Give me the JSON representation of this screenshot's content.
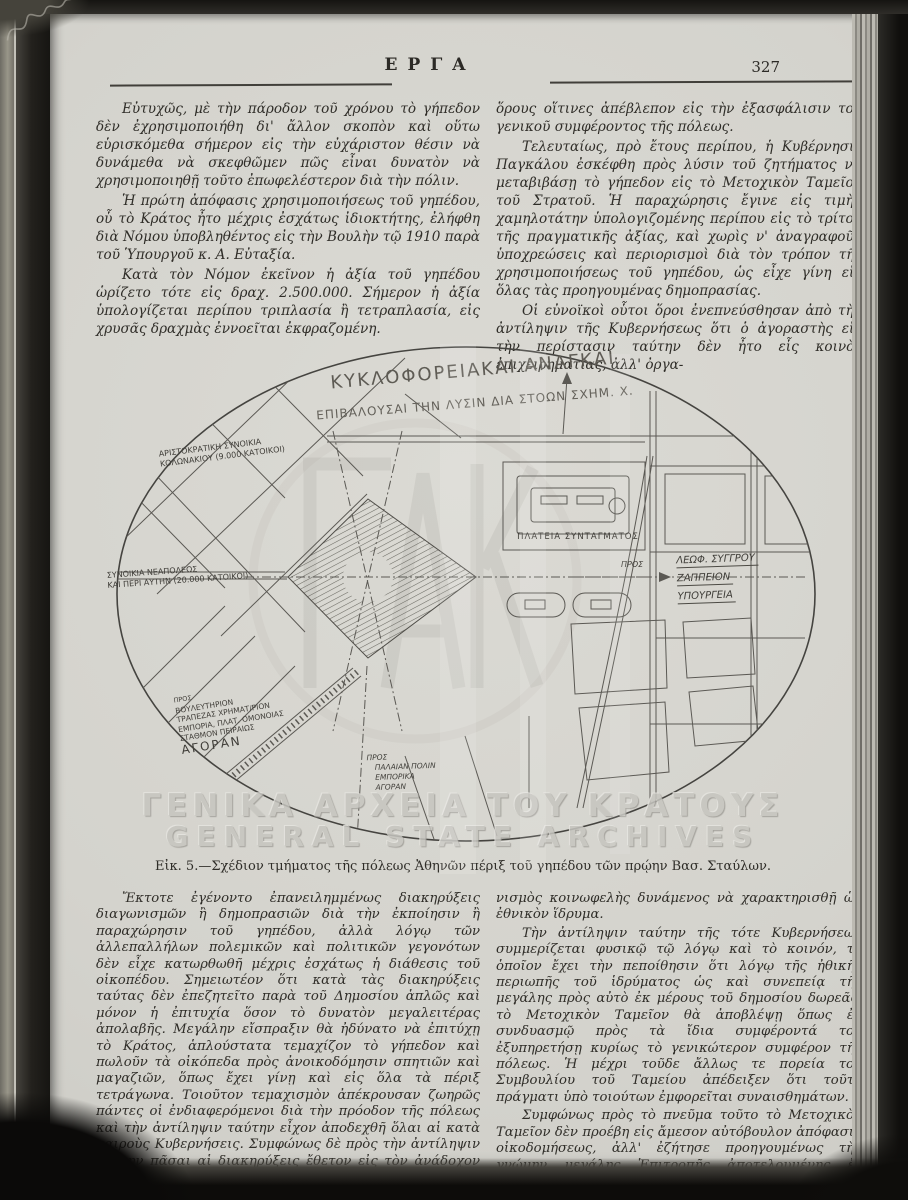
{
  "header": {
    "journal_title": "ΕΡΓΑ",
    "page_number": "327"
  },
  "top_section": {
    "left_column": {
      "paragraphs": [
        "Εὐτυχῶς, μὲ τὴν πάροδον τοῦ χρόνου τὸ γήπεδον δὲν ἐχρησιμοποιήθη δι' ἄλλον σκοπὸν καὶ οὕτω εὑρισκόμεθα σήμερον εἰς τὴν εὐχάριστον θέσιν νὰ δυνάμεθα νὰ σκεφθῶμεν πῶς εἶναι δυνατὸν νὰ χρησιμοποιηθῇ τοῦτο ἐπωφελέστερον διὰ τὴν πόλιν.",
        "Ἡ πρώτη ἀπόφασις χρησιμοποιήσεως τοῦ γηπέδου, οὗ τὸ Κράτος ἦτο μέχρις ἐσχάτως ἰδιοκτήτης, ἐλήφθη διὰ Νόμου ὑποβληθέντος εἰς τὴν Βουλὴν τῷ 1910 παρὰ τοῦ Ὑπουργοῦ κ. Α. Εὐταξία.",
        "Κατὰ τὸν Νόμον ἐκεῖνον ἡ ἀξία τοῦ γηπέδου ὡρίζετο τότε εἰς δραχ. 2.500.000. Σήμερον ἡ ἀξία ὑπολογίζεται περίπου τριπλασία ἢ τετραπλασία, εἰς χρυσᾶς δραχμὰς ἐννοεῖται ἐκφραζομένη."
      ]
    },
    "right_column": {
      "paragraphs": [
        "ὅρους οἵτινες ἀπέβλεπον εἰς τὴν ἐξασφάλισιν τοῦ γενικοῦ συμφέροντος τῆς πόλεως.",
        "Τελευταίως, πρὸ ἔτους περίπου, ἡ Κυβέρνησις Παγκάλου ἐσκέφθη πρὸς λύσιν τοῦ ζητήματος νὰ μεταβιβάσῃ τὸ γήπεδον εἰς τὸ Μετοχικὸν Ταμεῖον τοῦ Στρατοῦ. Ἡ παραχώρησις ἔγινε εἰς τιμὴν χαμηλοτάτην ὑπολογιζομένης περίπου εἰς τὸ τρίτον τῆς πραγματικῆς ἀξίας, καὶ χωρὶς ν' ἀναγραφοῦν ὑποχρεώσεις καὶ περιορισμοὶ διὰ τὸν τρόπον τῆς χρησιμοποιήσεως τοῦ γηπέδου, ὡς εἶχε γίνη εἰς ὅλας τὰς προηγουμένας δημοπρασίας.",
        "Οἱ εὐνοϊκοὶ οὗτοι ὅροι ἐνεπνεύσθησαν ἀπὸ τὴν ἀντίληψιν τῆς Κυβερνήσεως ὅτι ὁ ἀγοραστὴς εἰς τὴν περίστασιν ταύτην δὲν ἦτο εἷς κοινὸς ἐπιχειρηματίας, ἀλλ' ὀργα-"
      ]
    }
  },
  "figure": {
    "caption": "Εἰκ. 5.—Σχέδιον τμήματος τῆς πόλεως Ἀθηνῶν πέριξ τοῦ γηπέδου τῶν πρῴην Βασ. Σταύλων.",
    "map": {
      "title_line1": "ΚΥΚΛΟΦΟΡΕΙΑΚΑΙ ΑΝΑΓΚΑΙ",
      "title_line2": "ΕΠΙΒΑΛΟΥΣΑΙ ΤΗΝ ΛΥΣΙΝ ΔΙΑ ΣΤΟΩΝ ΣΧΗΜ. Χ.",
      "labels": {
        "aristocratic_line1": "ΑΡΙΣΤΟΚΡΑΤΙΚΗ ΣΥΝΟΙΚΙΑ",
        "aristocratic_line2": "ΚΟΛΩΝΑΚΙΟΥ (9.000 ΚΑΤΟΙΚΟΙ)",
        "neapoleos_line1": "ΣΥΝΟΙΚΙΑ ΝΕΑΠΟΛΕΩΣ",
        "neapoleos_line2": "ΚΑΙ ΠΕΡΙ ΑΥΤΗΝ (20.000 ΚΑΤΟΙΚΟΙ)",
        "syntagma": "ΠΛΑΤΕΙΑ ΣΥΝΤΑΓΜΑΤΟΣ",
        "pros_right": "ΠΡΟΣ",
        "right_dest_1": "ΛΕΩΦ. ΣΥΓΓΡΟΥ",
        "right_dest_2": "ΖΑΠΠΕΙΟΝ",
        "right_dest_3": "ΥΠΟΥΡΓΕΙΑ",
        "sw_pros": "ΠΡΟΣ",
        "sw_dest_1": "ΒΟΥΛΕΥΤΗΡΙΟΝ",
        "sw_dest_2": "ΤΡΑΠΕΖΑΣ ΧΡΗΜΑΤ/ΡΙΟΝ",
        "sw_dest_3": "ΕΜΠΟΡΙΑ, ΠΛΑΤ. ΟΜΟΝΟΙΑΣ",
        "sw_dest_4": "ΣΤΑΘΜΟΝ ΠΕΙΡΑΙΩΣ",
        "sw_dest_5": "ΑΓΟΡΑΝ",
        "s_pros": "ΠΡΟΣ",
        "s_dest_1": "ΠΑΛΑΙΑΝ ΠΟΛΙΝ",
        "s_dest_2": "ΕΜΠΟΡΙΚΑ",
        "s_dest_3": "ΑΓΟΡΑΝ"
      }
    }
  },
  "bottom_section": {
    "left_column": {
      "paragraphs": [
        "Ἔκτοτε ἐγένοντο ἐπανειλημμένως διακηρύξεις διαγωνισμῶν ἢ δημοπρασιῶν διὰ τὴν ἐκποίησιν ἢ παραχώρησιν τοῦ γηπέδου, ἀλλὰ λόγῳ τῶν ἀλλεπαλλήλων πολεμικῶν καὶ πολιτικῶν γεγονότων δὲν εἶχε κατωρθωθῆ μέχρις ἐσχάτως ἡ διάθεσις τοῦ οἰκοπέδου. Σημειωτέον ὅτι κατὰ τὰς διακηρύξεις ταύτας δὲν ἐπεζητεῖτο παρὰ τοῦ Δημοσίου ἁπλῶς καὶ μόνον ἡ ἐπιτυχία ὅσον τὸ δυνατὸν μεγαλειτέρας ἀπολαβῆς. Μεγάλην εἴσπραξιν θὰ ἠδύνατο νὰ ἐπιτύχῃ τὸ Κράτος, ἁπλούστατα τεμαχίζον τὸ γήπεδον καὶ πωλοῦν τὰ οἰκόπεδα πρὸς ἀνοικοδόμησιν σπητιῶν καὶ μαγαζιῶν, ὅπως ἔχει γίνῃ καὶ εἰς ὅλα τὰ πέριξ τετράγωνα. Τοιοῦτον τεμαχισμὸν ἀπέκρουσαν ζωηρῶς πάντες οἱ ἐνδιαφερόμενοι διὰ τὴν πρόοδον τῆς πόλεως καὶ τὴν ἀντίληψιν ταύτην εἶχον ἀποδεχθῆ ὅλαι αἱ κατὰ καιροὺς Κυβερνήσεις. Συμφώνως δὲ πρὸς τὴν ἀντίληψιν ταύτην πᾶσαι αἱ διακηρύξεις ἔθετον εἰς τὸν ἀνάδοχον αὐστηροὺς"
      ]
    },
    "right_column": {
      "paragraphs": [
        "νισμὸς κοινωφελὴς δυνάμενος νὰ χαρακτηρισθῇ ὡς ἐθνικὸν ἵδρυμα.",
        "Τὴν ἀντίληψιν ταύτην τῆς τότε Κυβερνήσεως συμμερίζεται φυσικῷ τῷ λόγῳ καὶ τὸ κοινόν, τὸ ὁποῖον ἔχει τὴν πεποίθησιν ὅτι λόγῳ τῆς ἠθικῆς περιωπῆς τοῦ ἱδρύματος ὡς καὶ συνεπείᾳ τῆς μεγάλης πρὸς αὐτὸ ἐκ μέρους τοῦ δημοσίου δωρεᾶς, τὸ Μετοχικὸν Ταμεῖον θὰ ἀποβλέψῃ ὅπως ἐν συνδυασμῷ πρὸς τὰ ἴδια συμφέροντά του ἐξυπηρετήσῃ κυρίως τὸ γενικώτερον συμφέρον τῆς πόλεως. Ἡ μέχρι τοῦδε ἄλλως τε πορεία τοῦ Συμβουλίου τοῦ Ταμείου ἀπέδειξεν ὅτι τοῦτο πράγματι ὑπὸ τοιούτων ἐμφορεῖται συναισθημάτων.",
        "Συμφώνως πρὸς τὸ πνεῦμα τοῦτο τὸ Μετοχικὸν Ταμεῖον δὲν προέβη εἰς ἄμεσον αὐτόβουλον ἀπόφασιν οἰκοδομήσεως, ἀλλ' ἐζήτησε προηγουμένως τὴν γνώμην μεγάλης Ἐπιτροπῆς ἀποτελουμένης ἐξ ἀξιωματικῶν, ἀρχιτε-"
      ]
    }
  },
  "watermark": {
    "line1": "ΓΕΝΙΚΑ ΑΡΧΕΙΑ ΤΟΥ ΚΡΑΤΟΥΣ",
    "line2": "GENERAL STATE ARCHIVES"
  },
  "colors": {
    "paper": "#d8d6d0",
    "ink": "#2f2d28",
    "map_line": "#5b5954",
    "watermark": "#c6c5bf"
  }
}
